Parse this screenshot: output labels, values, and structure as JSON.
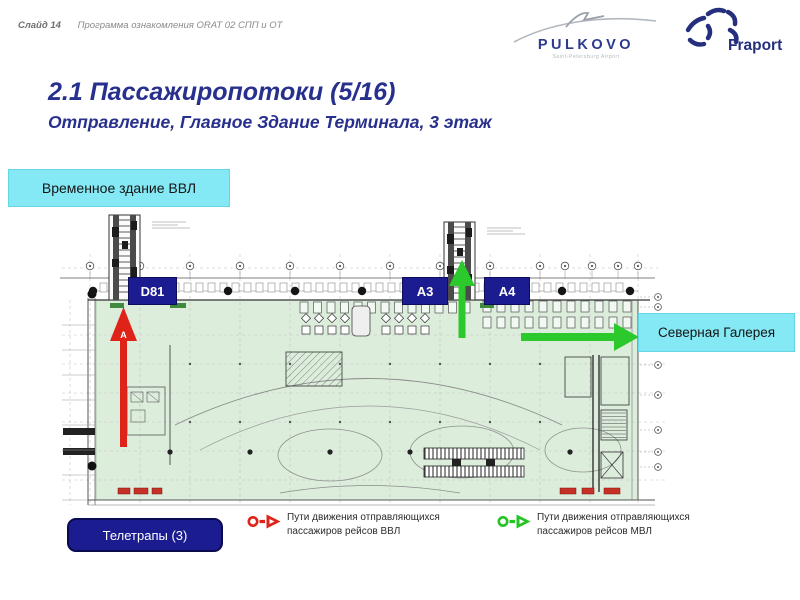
{
  "header": {
    "slide_label": "Слайд 14",
    "program_title": "Программа ознакомления ORAT 02 СПП и ОТ"
  },
  "logos": {
    "pulkovo_text": "PULKOVO",
    "pulkovo_subtext": "Saint-Petersburg Airport",
    "fraport_text": "Fraport"
  },
  "title": "2.1 Пассажиропотоки (5/16)",
  "subtitle": "Отправление, Главное Здание Терминала, 3 этаж",
  "callouts": {
    "temporary_building": "Временное здание ВВЛ",
    "north_gallery": "Северная Галерея",
    "jet_bridges": "Телетрапы (3)"
  },
  "plan": {
    "gates": {
      "d81": "D81",
      "a3": "A3",
      "a4": "A4"
    },
    "arrow_marker_letter": "А"
  },
  "legend": {
    "vvl": {
      "line1": "Пути движения отправляющихся",
      "line2": "пассажиров рейсов ВВЛ",
      "color": "#e02318"
    },
    "mvl": {
      "line1": "Пути движения отправляющихся",
      "line2": "пассажиров рейсов МВЛ",
      "color": "#22c522"
    }
  },
  "colors": {
    "accent_cyan": "#84e9f4",
    "navy": "#1b1c90",
    "title_blue": "#28308e",
    "plan_green": "#dceddc",
    "route_vvl_red": "#e02318",
    "route_mvl_green": "#2bc92b"
  }
}
